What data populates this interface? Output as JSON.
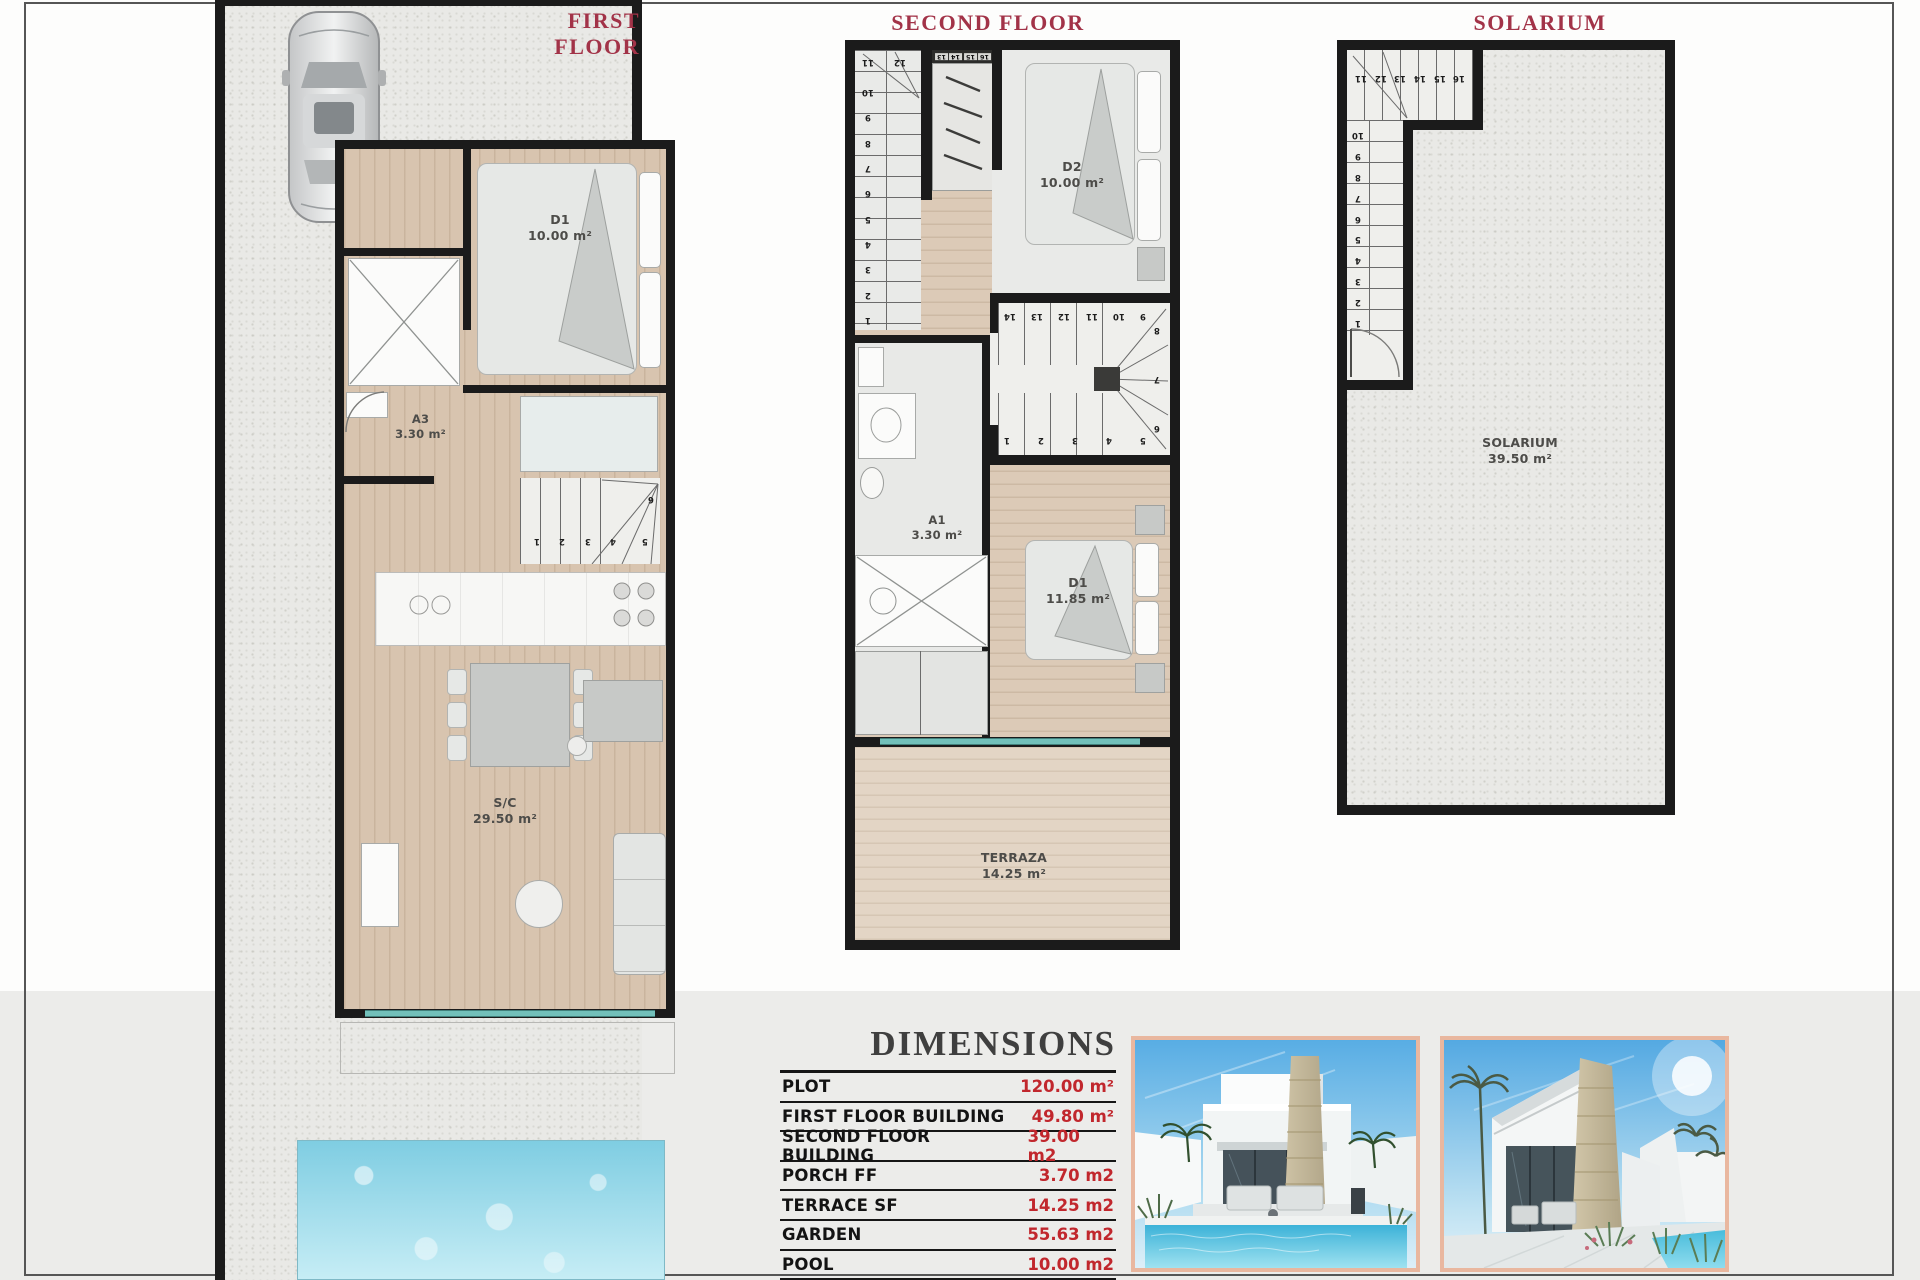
{
  "colors": {
    "plan_title_red": "#a23348",
    "dimension_value_red": "#c1272d",
    "wall_black": "#1b1b1b",
    "wood_floor": "#d8c4af",
    "glass_teal": "#72c0ba",
    "photo_border_salmon": "#e9b79f",
    "band_grey": "#ececea"
  },
  "plans": {
    "first": {
      "title": "FIRST FLOOR",
      "rooms": {
        "d1": {
          "label": "D1",
          "area": "10.00 m²"
        },
        "a3": {
          "label": "A3",
          "area": "3.30 m²"
        },
        "sc": {
          "label": "S/C",
          "area": "29.50 m²"
        }
      },
      "stairs": {
        "bottom_row": [
          "1",
          "2",
          "3",
          "4"
        ],
        "side": [
          "6",
          "5"
        ]
      }
    },
    "second": {
      "title": "SECOND FLOOR",
      "rooms": {
        "d2": {
          "label": "D2",
          "area": "10.00 m²"
        },
        "a1": {
          "label": "A1",
          "area": "3.30 m²"
        },
        "d1": {
          "label": "D1",
          "area": "11.85 m²"
        },
        "terraza": {
          "label": "TERRAZA",
          "area": "14.25 m²"
        }
      },
      "stairs_upper": {
        "top_row": [
          "11",
          "12"
        ],
        "column": [
          "10",
          "9",
          "8",
          "7",
          "6",
          "5",
          "4",
          "3",
          "2",
          "1"
        ],
        "closet_row": [
          "13",
          "14",
          "15",
          "16"
        ]
      },
      "stairs_mid": {
        "top_row": [
          "14",
          "13",
          "12",
          "11",
          "10",
          "9"
        ],
        "right_col": [
          "8",
          "7",
          "6"
        ],
        "bottom_row": [
          "1",
          "2",
          "3",
          "4",
          "5"
        ]
      }
    },
    "solarium": {
      "title": "SOLARIUM",
      "rooms": {
        "solarium": {
          "label": "SOLARIUM",
          "area": "39.50 m²"
        }
      },
      "stairs": {
        "top_row": [
          "11",
          "12",
          "13",
          "14",
          "15",
          "16"
        ],
        "column": [
          "10",
          "9",
          "8",
          "7",
          "6",
          "5",
          "4",
          "3",
          "2",
          "1"
        ]
      }
    }
  },
  "dimensions": {
    "title": "DIMENSIONS",
    "rows": [
      {
        "label": "PLOT",
        "value": "120.00 m²"
      },
      {
        "label": "FIRST FLOOR BUILDING",
        "value": "49.80 m²"
      },
      {
        "label": "SECOND FLOOR BUILDING",
        "value": "39.00 m2"
      },
      {
        "label": "PORCH FF",
        "value": "3.70 m2"
      },
      {
        "label": "TERRACE SF",
        "value": "14.25 m2"
      },
      {
        "label": "GARDEN",
        "value": "55.63 m2"
      },
      {
        "label": "POOL",
        "value": "10.00 m2"
      }
    ]
  }
}
